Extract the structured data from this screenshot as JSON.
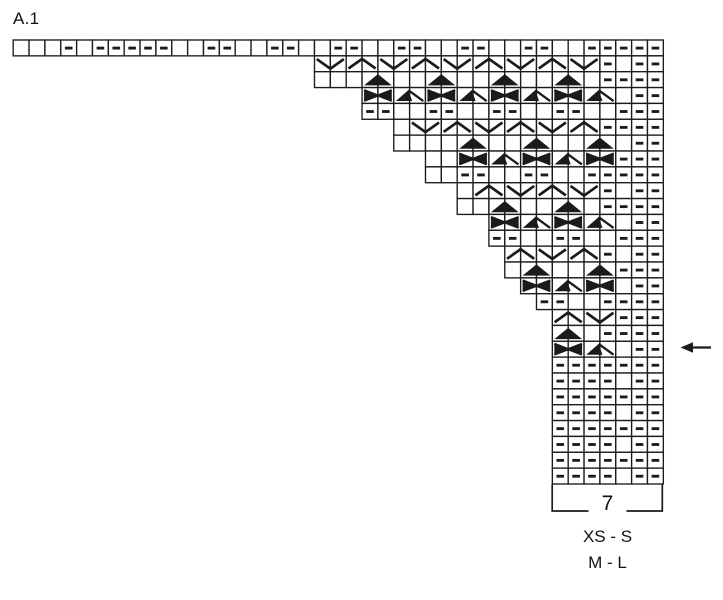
{
  "title": "A.1",
  "colors": {
    "ink": "#1b1b1b",
    "background": "#ffffff"
  },
  "chart_data": {
    "type": "knitting-chart",
    "title": "A.1",
    "columns": 41,
    "rows_count": 28,
    "symbol_legend": {
      ".": "empty square (knit)",
      "-": "purl dash",
      "V": "wide V symbol spanning 2 squares",
      "A": "wide inverted-V symbol spanning 2 squares",
      "T": "solid black triangle spanning 2 squares",
      "X": "solid bowtie cross spanning 2 squares",
      "D": "solid half-triangle with diagonal tail spanning 2 squares"
    },
    "rows": [
      {
        "row": 1,
        "start_col": 1,
        "cells": "...-.-----..--..--..--..--..--..--..-----"
      },
      {
        "row": 2,
        "start_col": 20,
        "cells": "VAVAVAVAV-.--"
      },
      {
        "row": 3,
        "start_col": 20,
        "cells": "...T..T..T..T.----"
      },
      {
        "row": 4,
        "start_col": 23,
        "cells": "XDXDXDXD.--"
      },
      {
        "row": 5,
        "start_col": 23,
        "cells": "--..--..--..--..---"
      },
      {
        "row": 6,
        "start_col": 25,
        "cells": ".VAVAVA----"
      },
      {
        "row": 7,
        "start_col": 25,
        "cells": "....T..T..T.--"
      },
      {
        "row": 8,
        "start_col": 27,
        "cells": "..XDXDX---"
      },
      {
        "row": 9,
        "start_col": 27,
        "cells": "..--..--..-----"
      },
      {
        "row": 10,
        "start_col": 29,
        "cells": ".AVAV-.--"
      },
      {
        "row": 11,
        "start_col": 29,
        "cells": "..T..T.----"
      },
      {
        "row": 12,
        "start_col": 31,
        "cells": "XDXD.--"
      },
      {
        "row": 13,
        "start_col": 31,
        "cells": "--..--..---"
      },
      {
        "row": 14,
        "start_col": 32,
        "cells": "AVA-.--"
      },
      {
        "row": 15,
        "start_col": 32,
        "cells": ".T..T---"
      },
      {
        "row": 16,
        "start_col": 33,
        "cells": "XDX.--"
      },
      {
        "row": 17,
        "start_col": 34,
        "cells": "--..----"
      },
      {
        "row": 18,
        "start_col": 35,
        "cells": "AV---"
      },
      {
        "row": 19,
        "start_col": 35,
        "cells": "T.----"
      },
      {
        "row": 20,
        "start_col": 35,
        "cells": "XD.--"
      },
      {
        "row": 21,
        "start_col": 35,
        "cells": "-------"
      },
      {
        "row": 22,
        "start_col": 35,
        "cells": "----.--"
      },
      {
        "row": 23,
        "start_col": 35,
        "cells": "-------"
      },
      {
        "row": 24,
        "start_col": 35,
        "cells": "----.--"
      },
      {
        "row": 25,
        "start_col": 35,
        "cells": "-------"
      },
      {
        "row": 26,
        "start_col": 35,
        "cells": "----.--"
      },
      {
        "row": 27,
        "start_col": 35,
        "cells": "-------"
      },
      {
        "row": 28,
        "start_col": 35,
        "cells": "----.--"
      }
    ],
    "bracket": {
      "label": "7",
      "start_col": 35,
      "end_col": 41
    },
    "size_label_1": "XS - S",
    "size_label_2": "M - L",
    "arrow": {
      "row": 20,
      "direction": "left"
    }
  }
}
